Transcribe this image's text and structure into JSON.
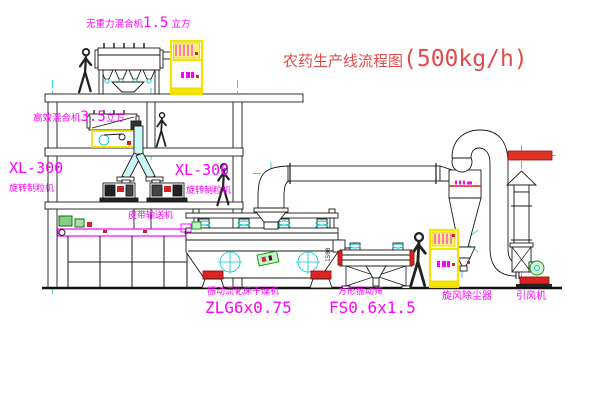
{
  "title": {
    "name_cn": "农药生产线流程图",
    "capacity": "(500kg/h)"
  },
  "labels": {
    "gravity_mixer": {
      "prefix": "无重力混合机",
      "value": "1.5",
      "suffix": " 立方"
    },
    "high_efficiency_mixer": {
      "prefix": "高效混合机",
      "value": "3.5",
      "suffix": "立方"
    },
    "granulator_left": {
      "model": "XL-300",
      "name": "旋转制粒机"
    },
    "granulator_right": {
      "model": "XL-300",
      "name": "旋转制粒机"
    },
    "belt_conveyor": "皮带输送机",
    "fluid_bed_dryer": {
      "name": "振动流化床干燥机",
      "model": "ZLG6x0.75"
    },
    "vibrating_screen": {
      "name": "方形振动筛",
      "model": "FS0.6x1.5"
    },
    "cyclone": "旋风除尘器",
    "induced_draft_fan": "引风机",
    "screen_dimension": "1500"
  },
  "colors": {
    "label_magenta": "#ff00ff",
    "title_red": "#e04b4b",
    "cad_red": "#dd2222",
    "cabinet_yellow": "#f5e400",
    "centerline_cyan": "#00cccc",
    "machine_green": "#009900"
  }
}
